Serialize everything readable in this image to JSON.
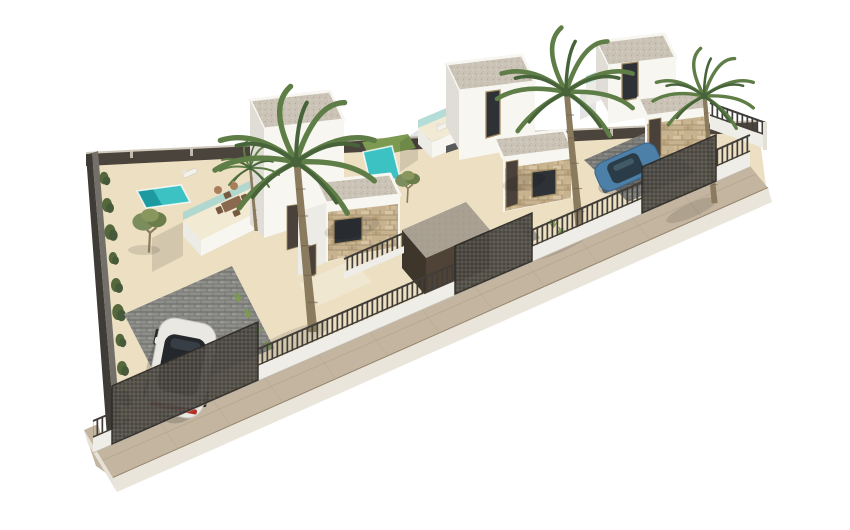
{
  "scene": {
    "type": "architectural-3d-render",
    "viewbox": "0 0 850 530",
    "description": "Aerial 3D architectural rendering of three modern white villas with stone accents, private turquoise pools, palm and olive trees, fenced sandy yards, two parked cars and a corner street sidewalk, isolated on a white background",
    "objects": [
      {
        "name": "villa-1",
        "label": "White villa with stone facade and roof terrace with dining set"
      },
      {
        "name": "villa-2",
        "label": "Two-storey white villa with stone entrance and terrace loungers"
      },
      {
        "name": "villa-3",
        "label": "Two-storey white villa at far end of the row"
      },
      {
        "name": "pool-1",
        "label": "Turquoise pool in the left garden"
      },
      {
        "name": "pool-2",
        "label": "Turquoise pool with lawn strip behind villa 1"
      },
      {
        "name": "roof-terrace-dining-set",
        "label": "Outdoor table, chairs and poufs on roof terrace"
      },
      {
        "name": "sun-loungers",
        "label": "Sun loungers in garden and on terrace"
      },
      {
        "name": "palm-trees",
        "label": "Four palm trees",
        "count": 4
      },
      {
        "name": "olive-trees",
        "label": "Two olive trees",
        "count": 2
      },
      {
        "name": "hedge-row",
        "label": "Shrub hedge along left boundary wall"
      },
      {
        "name": "white-car",
        "label": "White car parked on block-paved driveway"
      },
      {
        "name": "blue-car",
        "label": "Blue car parked behind entrance gate"
      },
      {
        "name": "front-fence",
        "label": "White plinth wall with dark metal railing"
      },
      {
        "name": "gates",
        "label": "Dark mesh driveway gates",
        "count": 3
      },
      {
        "name": "rear-wall",
        "label": "Dark rear boundary wall with posts"
      },
      {
        "name": "sidewalk",
        "label": "Corner pavement wrapping the plot"
      },
      {
        "name": "driveways",
        "label": "Paved driveways",
        "count": 3
      },
      {
        "name": "brown-wall",
        "label": "Dark brown dividing garage wall"
      }
    ]
  },
  "colors": {
    "bg": "#ffffff",
    "sand": "#ecdfc2",
    "sand_light": "#f3ead3",
    "sidewalk": "#c4b5a0",
    "sidewalk_edge": "#93836b",
    "curb": "#e9e5da",
    "rear_wall": "#4b443c",
    "left_wall": "#73706a",
    "left_wall_dark": "#3f3c37",
    "hedge": "#55683c",
    "pool": "#3cc2c3",
    "pool_dark": "#1a969c",
    "lawn": "#7d9a51",
    "white_lit": "#f7f6f1",
    "white_mid": "#edebe5",
    "white_shade": "#e0ddd6",
    "gravel": "#cbc4b6",
    "stone": "#c7b290",
    "mesh": "#413e39",
    "plinth": "#efede7",
    "drive": "#8e8e8a",
    "drive_light": "#9d988e",
    "walkway": "#f0e7d1",
    "brown_wall": "#4f4236",
    "brown_wall_top": "#968d7f",
    "brown_wall_side": "#3e352b",
    "door_dark": "#4a423a",
    "window_dark": "#2e3236",
    "frame_tan": "#a38c62",
    "glass_teal": "#a7d7d1",
    "trunk": "#8a7a5e",
    "palm": "#5f7d46",
    "palm_dark": "#47633a",
    "olive": "#7c8d5d",
    "car_white": "#e9e8e3",
    "car_glass": "#24282c",
    "car_red": "#b23029",
    "car_blue": "#4d80a8",
    "car_blue_glass": "#2a3c48"
  }
}
